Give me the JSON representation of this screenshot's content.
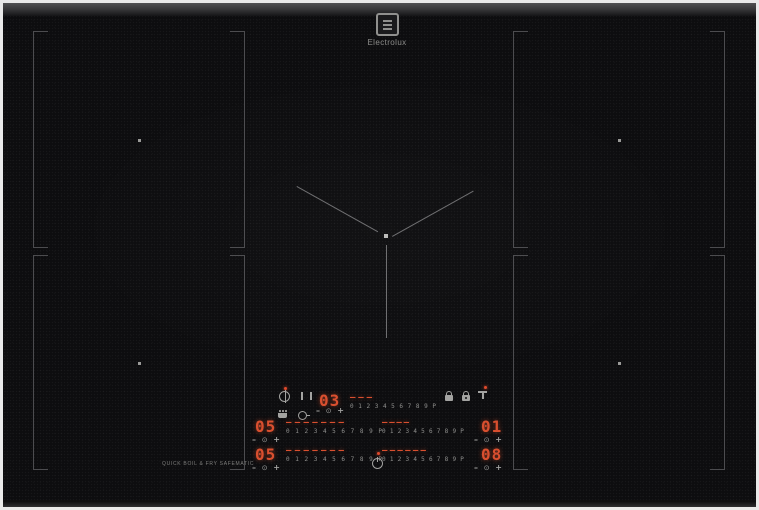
{
  "brand": {
    "name": "Electrolux"
  },
  "timer": {
    "value": "03",
    "dashes": "– – –"
  },
  "zones": {
    "left1": {
      "power": "05",
      "dashes": "– – – – – – –"
    },
    "right1": {
      "power": "01",
      "dashes": "– – – –"
    },
    "left2": {
      "power": "05",
      "dashes": "– – – – – – –"
    },
    "right2": {
      "power": "08",
      "dashes": "– – – – – –"
    }
  },
  "scale": {
    "marks": "0 1 2 3 4 5 6 7 8 9 P"
  },
  "controls": {
    "minus": "–",
    "ok": "⊙",
    "plus": "+"
  },
  "footer": {
    "label": "QUICK BOIL & FRY SAFEMATIC"
  },
  "colors": {
    "led": "#d94f2f",
    "zone_line": "#4c4c4f",
    "icon": "#a3a3a1",
    "surface": "#0d0d0f"
  },
  "icons": {
    "top_left": [
      "bridge-icon",
      "pause-icon"
    ],
    "lower_left": [
      "sense-boil-icon",
      "sense-fry-icon"
    ],
    "top_right": [
      "lock-icon",
      "child-lock-icon",
      "hob2hood-icon"
    ],
    "center": [
      "power-icon"
    ],
    "indicators": [
      "bridge-indicator-dot",
      "hob2hood-indicator-dot",
      "power-indicator-dot"
    ]
  }
}
